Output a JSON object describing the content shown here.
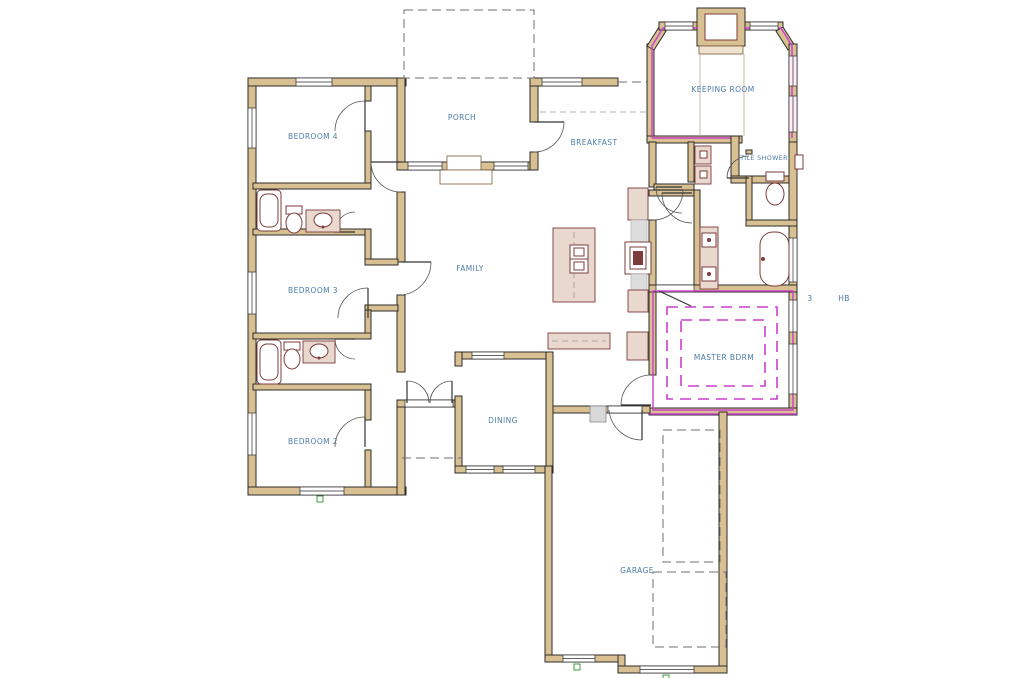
{
  "drawing": {
    "type": "architectural-floor-plan",
    "description": "Single-story residential house floor plan, CAD style"
  },
  "colors": {
    "wall-fill": "#d8c092",
    "wall-stroke": "#2b2b2b",
    "highlight-magenta": "#cc3ecc",
    "label-blue": "#4d7ca8",
    "fixture-red": "#7d3b3b",
    "vanity-fill": "#e9d8ce",
    "dash-gray": "#6f6f6f",
    "marker-green": "#3f9c3f",
    "step-gray": "#d8d8d8",
    "paper": "#ffffff"
  },
  "rooms": {
    "bedroom4": {
      "label": "BEDROOM 4"
    },
    "porch": {
      "label": "PORCH"
    },
    "breakfast": {
      "label": "BREAKFAST"
    },
    "keeping": {
      "label": "KEEPING ROOM"
    },
    "tileshower": {
      "label": "TILE SHOWER"
    },
    "family": {
      "label": "FAMILY"
    },
    "bedroom3": {
      "label": "BEDROOM 3"
    },
    "master": {
      "label": "MASTER BDRM"
    },
    "bedroom2": {
      "label": "BEDROOM 2"
    },
    "dining": {
      "label": "DINING"
    },
    "garage": {
      "label": "GARAGE"
    }
  },
  "annotations": {
    "marker": {
      "label": "3"
    },
    "hose_bib": {
      "label": "HB"
    }
  }
}
